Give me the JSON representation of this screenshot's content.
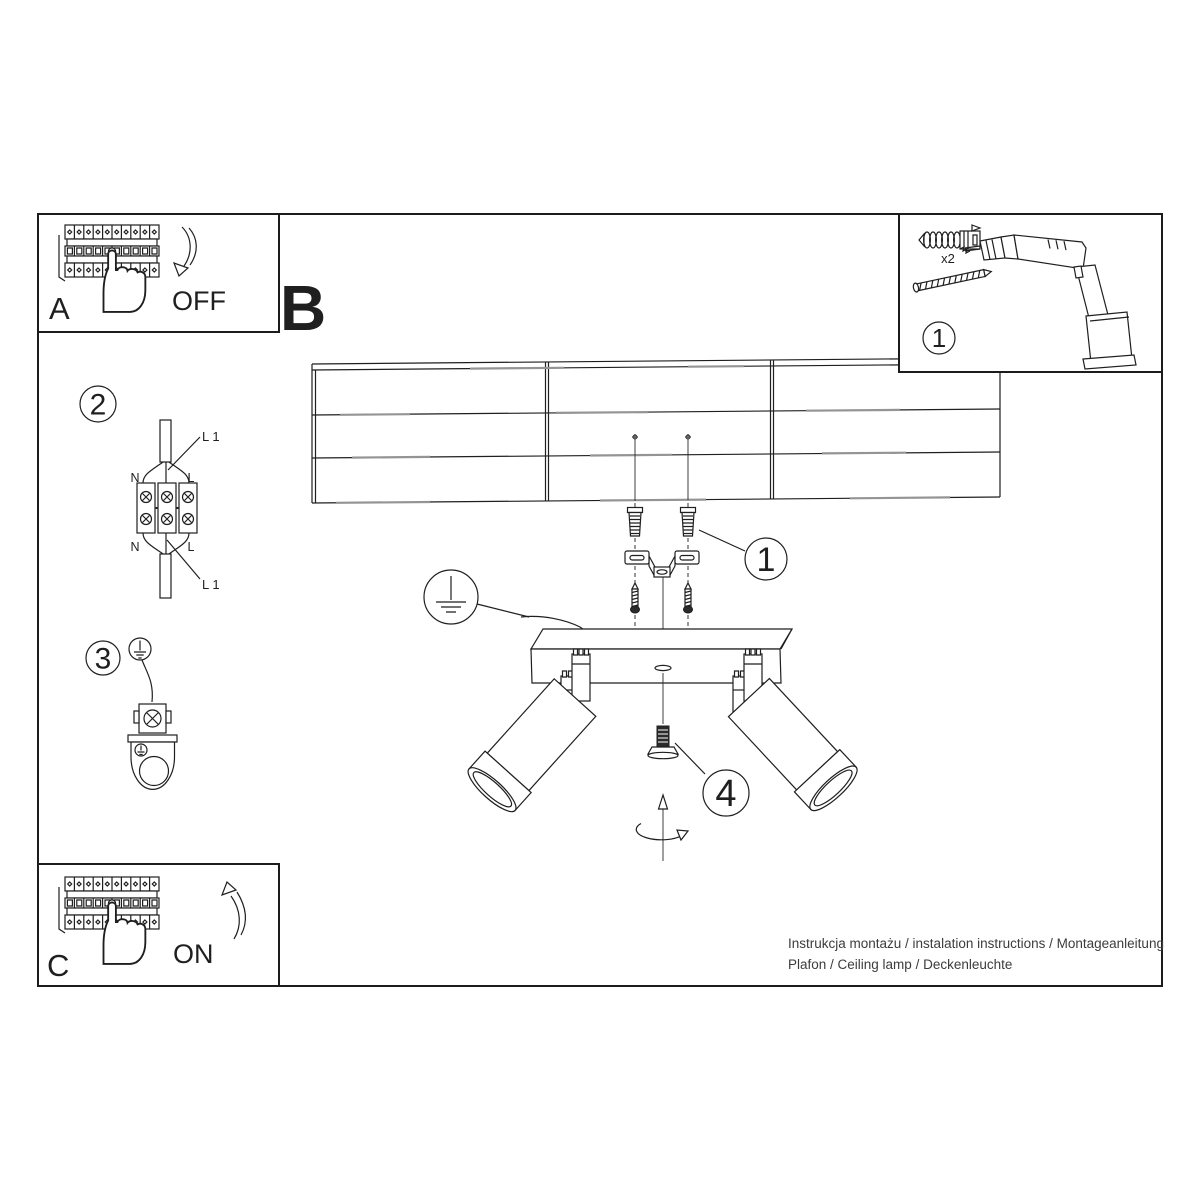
{
  "colors": {
    "line": "#1f1f1f",
    "paper": "#ffffff",
    "accent_gray": "#949494"
  },
  "panel_a": {
    "label": "A",
    "action": "OFF"
  },
  "section_b": {
    "label": "B"
  },
  "panel_c": {
    "label": "C",
    "action": "ON"
  },
  "tools_box": {
    "callout": "1",
    "plug_quantity": "x2"
  },
  "callouts": {
    "bracket": "1",
    "wiring": "2",
    "grounding": "3",
    "adjust_screw": "4"
  },
  "wiring_diagram": {
    "line_top": "L 1",
    "line_bottom": "L 1",
    "neutral": "N",
    "live": "L"
  },
  "footer": {
    "line1": "Instrukcja montażu / instalation instructions / Montageanleitung",
    "line2": "Plafon / Ceiling lamp / Deckenleuchte"
  }
}
